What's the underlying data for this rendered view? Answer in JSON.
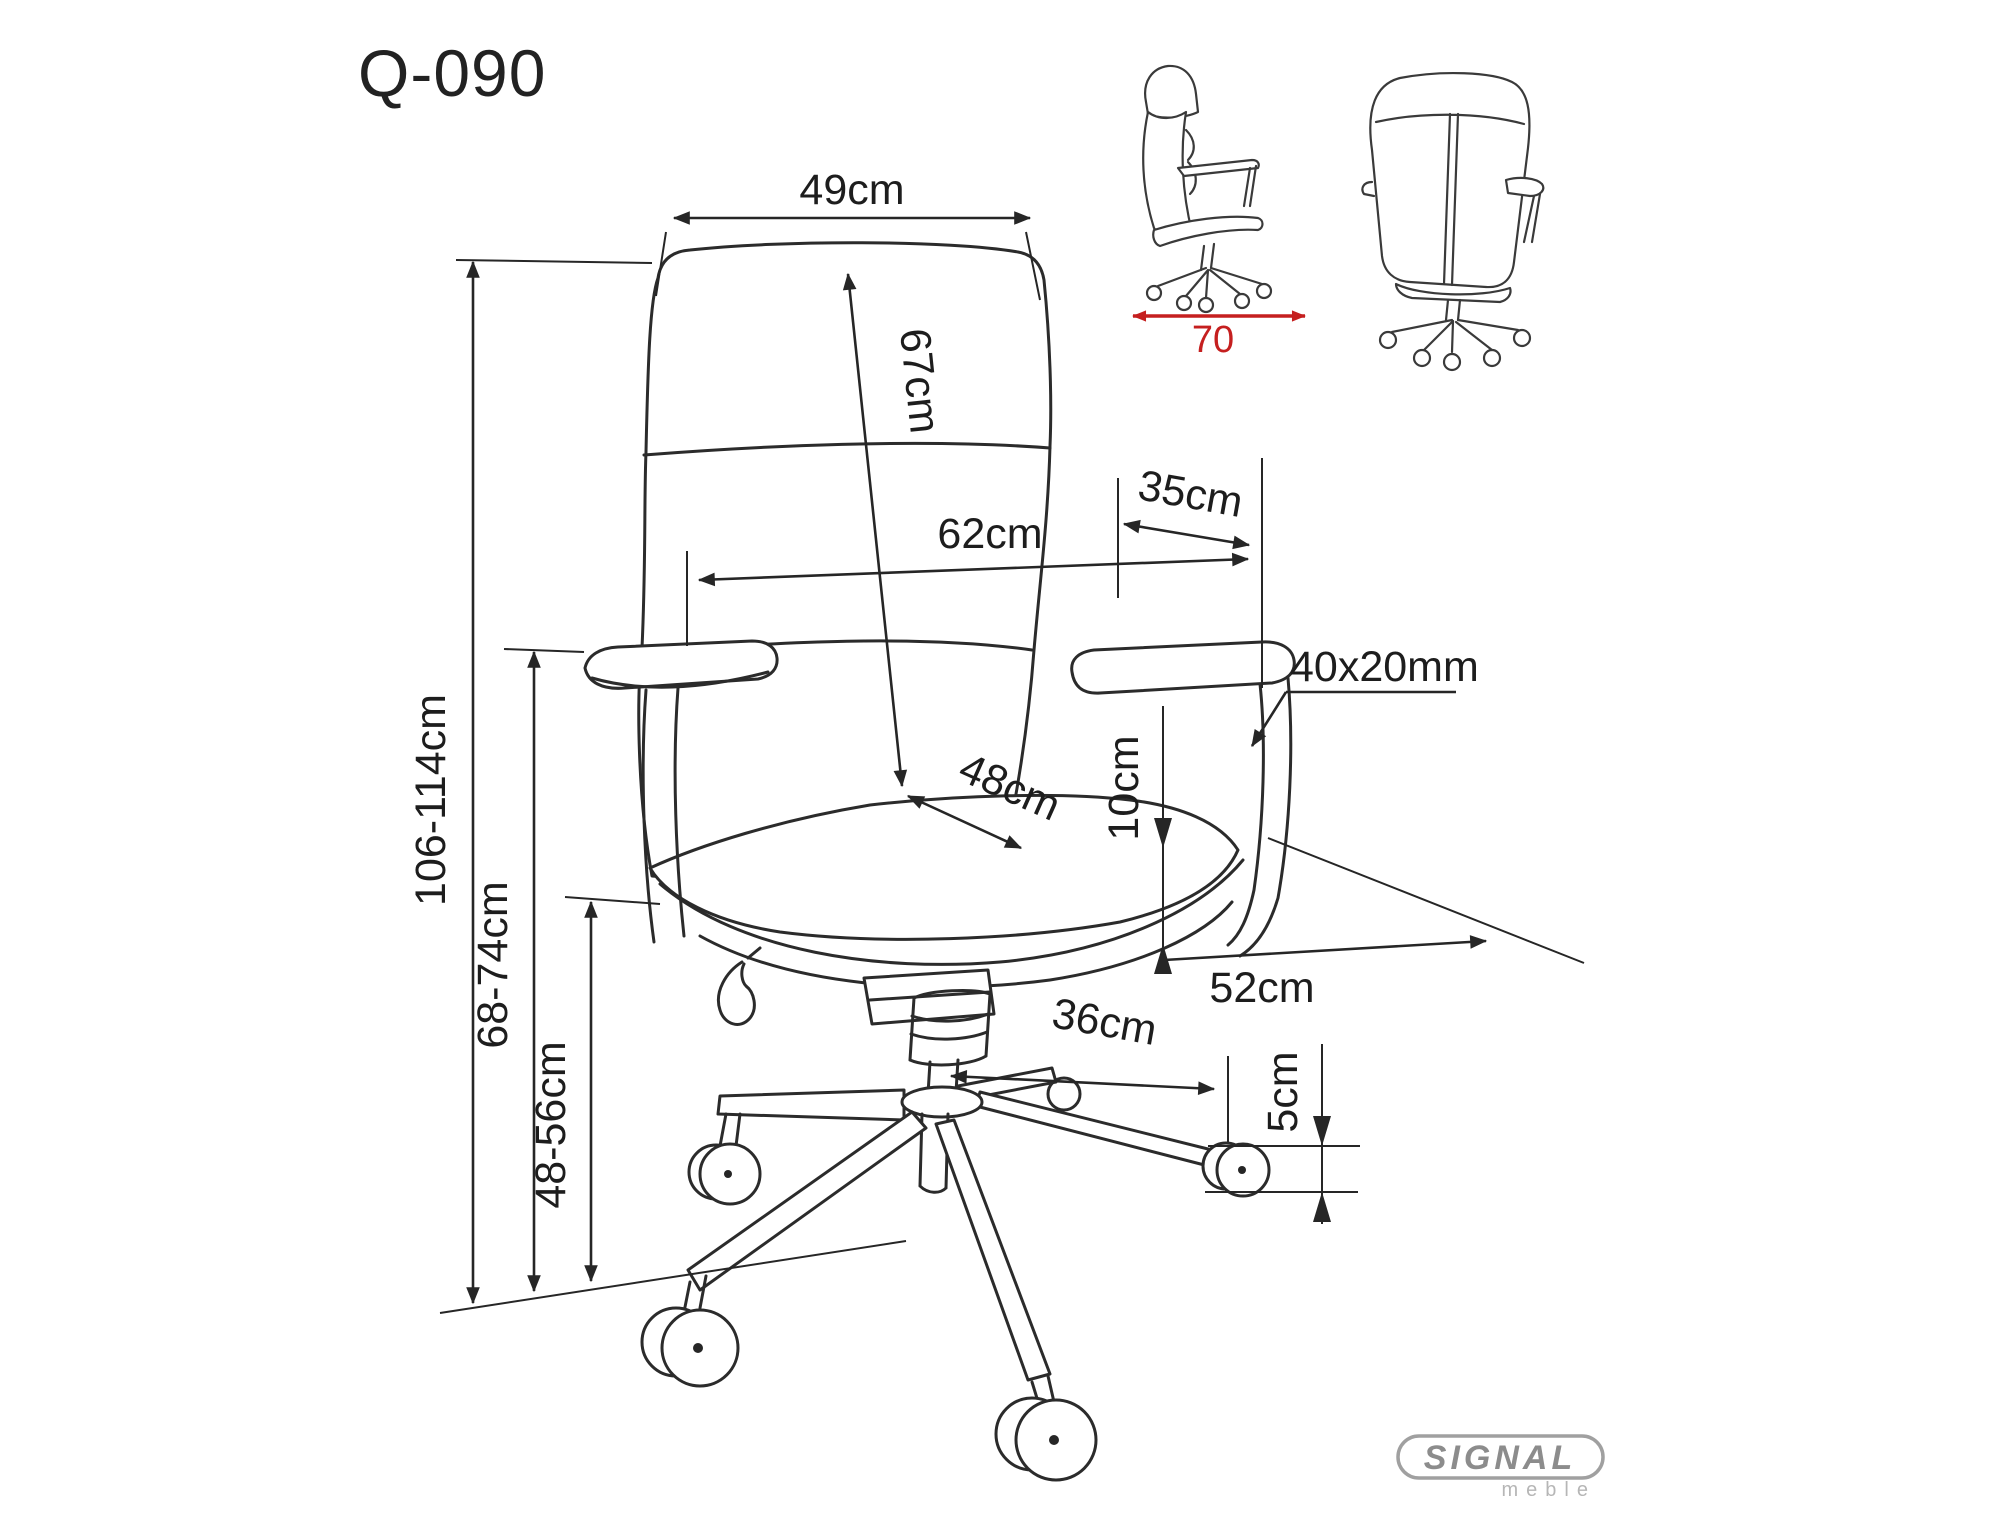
{
  "title": "Q-090",
  "brand": {
    "name": "SIGNAL",
    "sub": "meble"
  },
  "colors": {
    "line": "#2b2b2b",
    "accent_red": "#c51f1f",
    "logo_gray": "#8c8c8c"
  },
  "dims": {
    "backrest_width": "49cm",
    "backrest_height": "67cm",
    "armrest_length": "35cm",
    "total_width": "62cm",
    "armrest_profile": "40x20mm",
    "seat_width": "48cm",
    "seat_side_thickness": "10cm",
    "total_height": "106-114cm",
    "armrest_height": "68-74cm",
    "seat_height": "48-56cm",
    "seat_depth": "52cm",
    "base_radius": "36cm",
    "caster_height": "5cm",
    "overall_depth": "70"
  }
}
